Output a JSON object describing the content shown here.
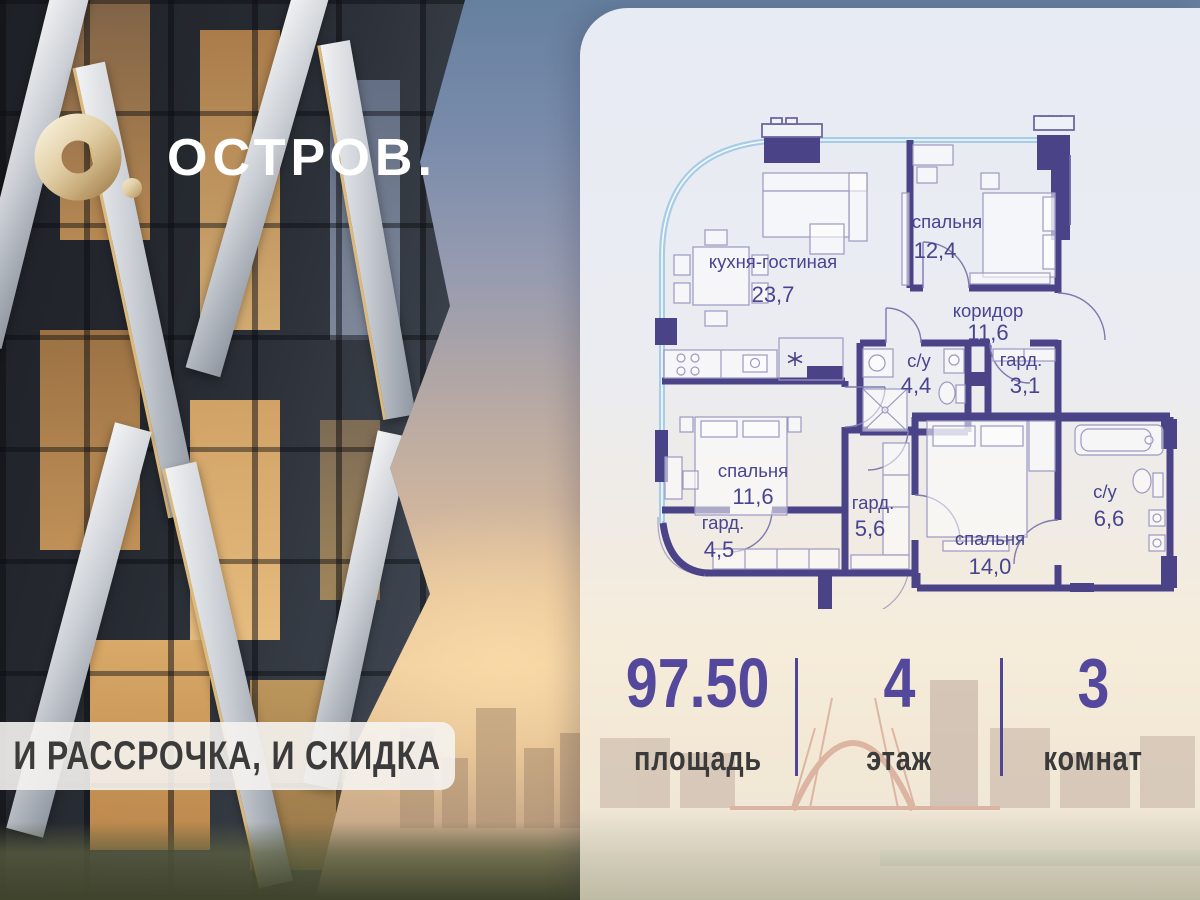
{
  "brand": {
    "name": "ОСТРОВ."
  },
  "banner": {
    "text": "И РАССРОЧКА, И СКИДКА"
  },
  "floorplan": {
    "rooms": [
      {
        "name": "кухня-гостиная",
        "area": "23,7"
      },
      {
        "name": "спальня",
        "area": "12,4"
      },
      {
        "name": "коридор",
        "area": "11,6"
      },
      {
        "name": "с/у",
        "area": "4,4"
      },
      {
        "name": "гард.",
        "area": "3,1"
      },
      {
        "name": "спальня",
        "area": "11,6"
      },
      {
        "name": "гард.",
        "area": "4,5"
      },
      {
        "name": "гард.",
        "area": "5,6"
      },
      {
        "name": "спальня",
        "area": "14,0"
      },
      {
        "name": "с/у",
        "area": "6,6"
      }
    ]
  },
  "stats": {
    "items": [
      {
        "value": "97.50",
        "label": "площадь"
      },
      {
        "value": "4",
        "label": "этаж"
      },
      {
        "value": "3",
        "label": "комнат"
      }
    ]
  },
  "colors": {
    "wall": "#4b4388",
    "accent": "#53489c",
    "plan_text": "#494490",
    "stat_label": "#3a3a3a",
    "gold": "#d9c298",
    "glazing": "#a6cde5"
  }
}
